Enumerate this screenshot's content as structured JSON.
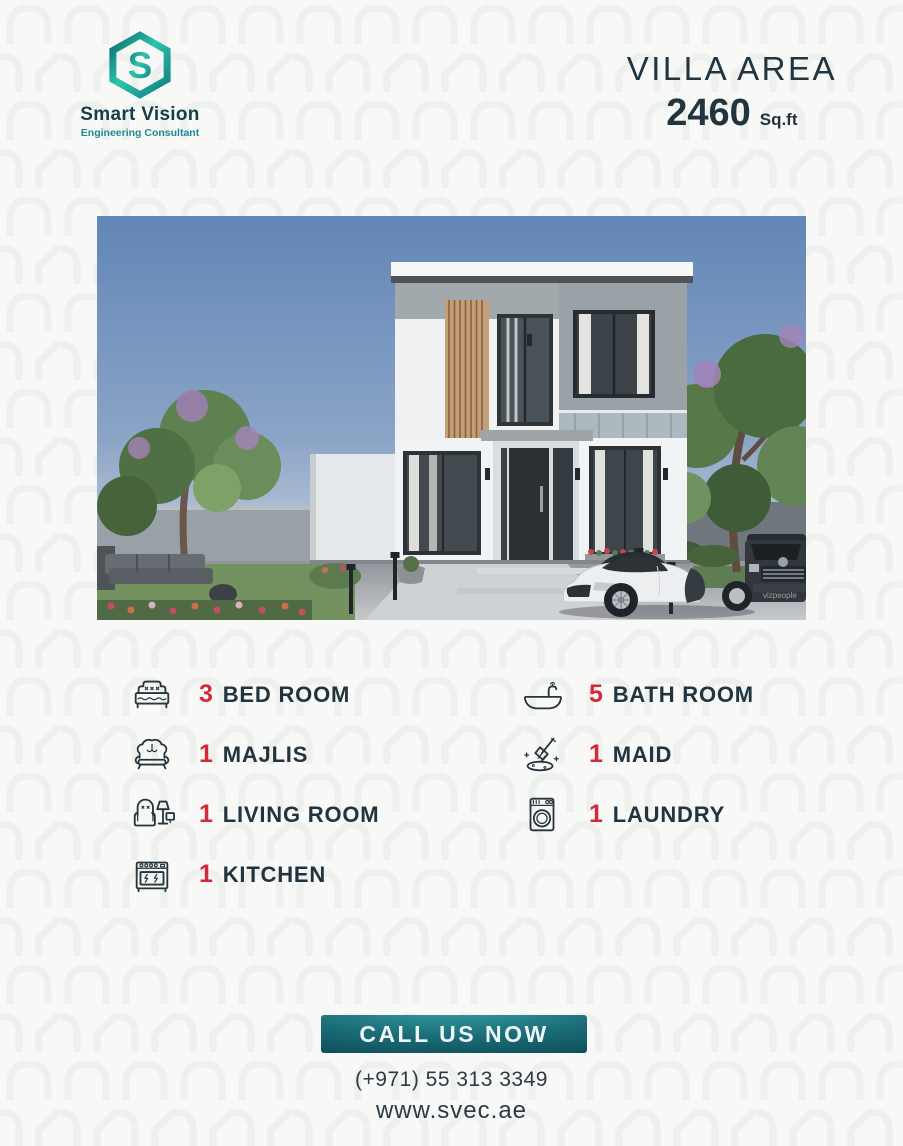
{
  "brand": {
    "name": "Smart Vision",
    "tagline": "Engineering Consultant",
    "name_color": "#123f4b",
    "tagline_color": "#1a8b92",
    "logo_teal_dark": "#0a6a6e",
    "logo_teal_light": "#2ec4ad"
  },
  "header": {
    "area_label": "VILLA AREA",
    "area_value": "2460",
    "area_unit": "Sq.ft"
  },
  "photo": {
    "alt": "modern two-storey white villa render with trees and white sports car",
    "watermark": "vizpeople"
  },
  "features": {
    "count_color": "#d2293b",
    "label_color": "#22343f",
    "left": [
      {
        "count": "3",
        "label": "BED ROOM",
        "icon": "bed-icon"
      },
      {
        "count": "1",
        "label": "MAJLIS",
        "icon": "sofa-icon"
      },
      {
        "count": "1",
        "label": "LIVING ROOM",
        "icon": "armchair-lamp-icon"
      },
      {
        "count": "1",
        "label": "KITCHEN",
        "icon": "stove-icon"
      }
    ],
    "right": [
      {
        "count": "5",
        "label": "BATH ROOM",
        "icon": "bathtub-icon"
      },
      {
        "count": "1",
        "label": "MAID",
        "icon": "mop-icon"
      },
      {
        "count": "1",
        "label": "LAUNDRY",
        "icon": "washing-machine-icon"
      }
    ]
  },
  "footer": {
    "cta_label": "CALL US NOW",
    "phone": "(+971) 55 313 3349",
    "website": "www.svec.ae"
  },
  "colors": {
    "background": "#f8f9f7",
    "navy": "#22343f",
    "red": "#d2293b",
    "button_teal_light": "#3aa3a4",
    "button_teal_dark": "#0b3f4e"
  }
}
